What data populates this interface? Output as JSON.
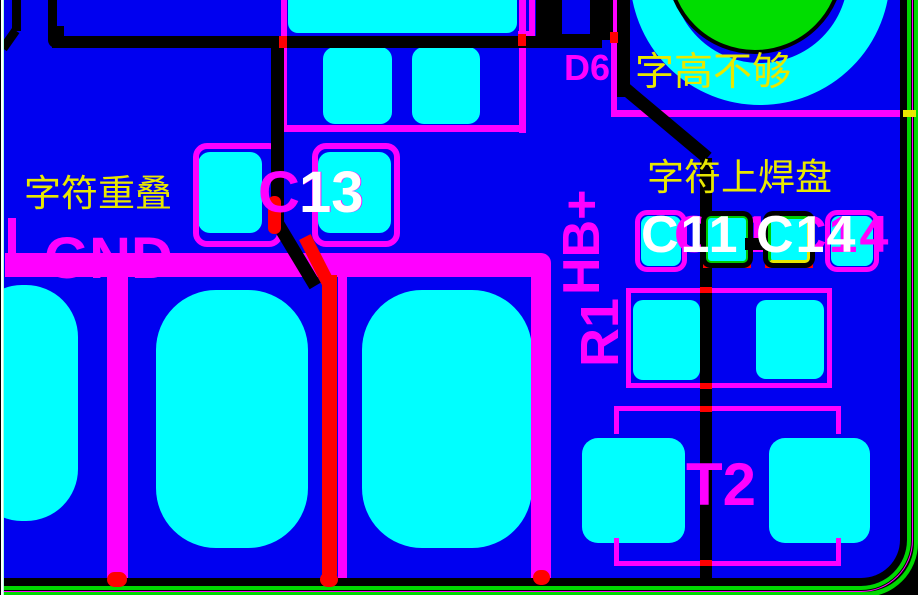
{
  "view": {
    "type": "pcb-layout-viewport",
    "background": "#0000f0"
  },
  "designators": {
    "gnd": "GND",
    "c13_silk": "C13",
    "c13_overlay": "13",
    "d6": "D6",
    "hb_plus": "HB+",
    "r1": "R1",
    "t2": "T2",
    "c11_c14_silk": "C11 C14",
    "c11_c14_overlay": "C11 C14"
  },
  "annotations": {
    "overlap": "字符重叠",
    "char_height": "字高不够",
    "char_on_pad": "字符上焊盘"
  },
  "colors": {
    "background": "#0000f0",
    "pad": "#00ffff",
    "silkscreen": "#ff00ff",
    "top-trace": "#000000",
    "bottom-trace": "#ff0000",
    "board-outline": "#00d800",
    "drill-hole": "#00dd00",
    "annotation": "#e8e800",
    "overlay-text": "#ffffff",
    "highlight-border": "#00cc00",
    "edge-line-white": "#ffffff",
    "edge-line-pale": "#aaffdd"
  }
}
